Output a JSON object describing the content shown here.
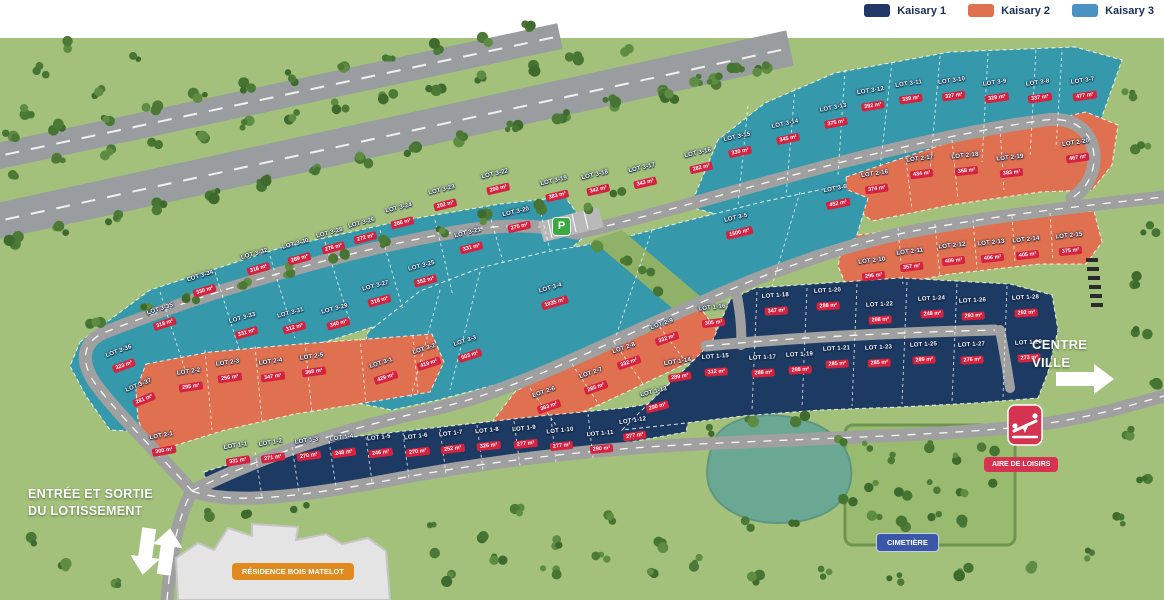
{
  "legend": {
    "items": [
      {
        "label": "Kaisary 1",
        "color": "#203767"
      },
      {
        "label": "Kaisary 2",
        "color": "#e0714f"
      },
      {
        "label": "Kaisary 3",
        "color": "#4a92c3"
      }
    ]
  },
  "labels": {
    "entrance_line1": "ENTRÉE ET SORTIE",
    "entrance_line2": "DU LOTISSEMENT",
    "residence": "RÉSIDENCE BOIS MATELOT",
    "cemetery": "CIMETIÈRE",
    "leisure": "AIRE DE LOISIRS",
    "centre_line1": "CENTRE",
    "centre_line2": "VILLE",
    "parking": "P"
  },
  "colors": {
    "zone_kaisary1": "#1d3a63",
    "zone_kaisary2": "#df7150",
    "zone_kaisary3": "#3598ab",
    "area_badge": "#d6213f"
  },
  "lots": [
    {
      "id": "LOT 3-1",
      "area": "429 m²",
      "g": 3,
      "x": 384,
      "y": 372,
      "r": -18
    },
    {
      "id": "LOT 3-2",
      "area": "419 m²",
      "g": 3,
      "x": 427,
      "y": 358,
      "r": -18
    },
    {
      "id": "LOT 3-3",
      "area": "503 m²",
      "g": 3,
      "x": 468,
      "y": 350,
      "r": -18
    },
    {
      "id": "LOT 3-4",
      "area": "1035 m²",
      "g": 3,
      "x": 553,
      "y": 297,
      "r": -16
    },
    {
      "id": "LOT 3-5",
      "area": "1506 m²",
      "g": 3,
      "x": 738,
      "y": 227,
      "r": -13
    },
    {
      "id": "LOT 3-6",
      "area": "452 m²",
      "g": 3,
      "x": 837,
      "y": 198,
      "r": -11
    },
    {
      "id": "LOT 3-7",
      "area": "477 m²",
      "g": 3,
      "x": 1084,
      "y": 90,
      "r": -8
    },
    {
      "id": "LOT 3-8",
      "area": "337 m²",
      "g": 3,
      "x": 1039,
      "y": 92,
      "r": -8
    },
    {
      "id": "LOT 3-9",
      "area": "329 m²",
      "g": 3,
      "x": 996,
      "y": 92,
      "r": -8
    },
    {
      "id": "LOT 3-10",
      "area": "327 m²",
      "g": 3,
      "x": 953,
      "y": 90,
      "r": -8
    },
    {
      "id": "LOT 3-11",
      "area": "339 m²",
      "g": 3,
      "x": 910,
      "y": 93,
      "r": -8
    },
    {
      "id": "LOT 3-12",
      "area": "392 m²",
      "g": 3,
      "x": 872,
      "y": 100,
      "r": -9
    },
    {
      "id": "LOT 3-13",
      "area": "375 m²",
      "g": 3,
      "x": 835,
      "y": 117,
      "r": -11
    },
    {
      "id": "LOT 3-14",
      "area": "345 m²",
      "g": 3,
      "x": 787,
      "y": 133,
      "r": -12
    },
    {
      "id": "LOT 3-15",
      "area": "330 m²",
      "g": 3,
      "x": 739,
      "y": 146,
      "r": -12
    },
    {
      "id": "LOT 3-16",
      "area": "282 m²",
      "g": 3,
      "x": 700,
      "y": 162,
      "r": -13
    },
    {
      "id": "LOT 3-17",
      "area": "343 m²",
      "g": 3,
      "x": 644,
      "y": 177,
      "r": -13
    },
    {
      "id": "LOT 3-18",
      "area": "342 m²",
      "g": 3,
      "x": 597,
      "y": 184,
      "r": -13
    },
    {
      "id": "LOT 3-19",
      "area": "383 m²",
      "g": 3,
      "x": 556,
      "y": 190,
      "r": -13
    },
    {
      "id": "LOT 3-20",
      "area": "275 m²",
      "g": 3,
      "x": 518,
      "y": 221,
      "r": -13
    },
    {
      "id": "LOT 3-21",
      "area": "331 m²",
      "g": 3,
      "x": 470,
      "y": 242,
      "r": -14
    },
    {
      "id": "LOT 3-22",
      "area": "290 m²",
      "g": 3,
      "x": 497,
      "y": 183,
      "r": -13
    },
    {
      "id": "LOT 3-23",
      "area": "292 m²",
      "g": 3,
      "x": 444,
      "y": 199,
      "r": -14
    },
    {
      "id": "LOT 3-24",
      "area": "286 m²",
      "g": 3,
      "x": 401,
      "y": 217,
      "r": -14
    },
    {
      "id": "LOT 3-25",
      "area": "352 m²",
      "g": 3,
      "x": 424,
      "y": 275,
      "r": -15
    },
    {
      "id": "LOT 3-26",
      "area": "272 m²",
      "g": 3,
      "x": 364,
      "y": 232,
      "r": -15
    },
    {
      "id": "LOT 3-27",
      "area": "318 m²",
      "g": 3,
      "x": 378,
      "y": 295,
      "r": -15
    },
    {
      "id": "LOT 3-28",
      "area": "276 m²",
      "g": 3,
      "x": 332,
      "y": 242,
      "r": -15
    },
    {
      "id": "LOT 3-29",
      "area": "340 m²",
      "g": 3,
      "x": 337,
      "y": 318,
      "r": -15
    },
    {
      "id": "LOT 3-30",
      "area": "289 m²",
      "g": 3,
      "x": 298,
      "y": 253,
      "r": -15
    },
    {
      "id": "LOT 3-31",
      "area": "312 m²",
      "g": 3,
      "x": 293,
      "y": 322,
      "r": -15
    },
    {
      "id": "LOT 3-32",
      "area": "316 m²",
      "g": 3,
      "x": 257,
      "y": 263,
      "r": -16
    },
    {
      "id": "LOT 3-33",
      "area": "331 m²",
      "g": 3,
      "x": 245,
      "y": 327,
      "r": -16
    },
    {
      "id": "LOT 3-34",
      "area": "330 m²",
      "g": 3,
      "x": 203,
      "y": 285,
      "r": -17
    },
    {
      "id": "LOT 3-35",
      "area": "318 m²",
      "g": 3,
      "x": 163,
      "y": 318,
      "r": -18
    },
    {
      "id": "LOT 3-36",
      "area": "323 m²",
      "g": 3,
      "x": 122,
      "y": 360,
      "r": -20
    },
    {
      "id": "LOT 3-37",
      "area": "281 m²",
      "g": 3,
      "x": 142,
      "y": 394,
      "r": -22
    },
    {
      "id": "LOT 2-1",
      "area": "300 m²",
      "g": 2,
      "x": 163,
      "y": 445,
      "r": -10
    },
    {
      "id": "LOT 2-2",
      "area": "295 m²",
      "g": 2,
      "x": 190,
      "y": 381,
      "r": -8
    },
    {
      "id": "LOT 2-3",
      "area": "256 m²",
      "g": 2,
      "x": 229,
      "y": 372,
      "r": -8
    },
    {
      "id": "LOT 2-4",
      "area": "347 m²",
      "g": 2,
      "x": 272,
      "y": 371,
      "r": -8
    },
    {
      "id": "LOT 2-5",
      "area": "368 m²",
      "g": 2,
      "x": 313,
      "y": 366,
      "r": -8
    },
    {
      "id": "LOT 2-6",
      "area": "363 m²",
      "g": 2,
      "x": 547,
      "y": 401,
      "r": -19
    },
    {
      "id": "LOT 2-7",
      "area": "285 m²",
      "g": 2,
      "x": 594,
      "y": 382,
      "r": -19
    },
    {
      "id": "LOT 2-8",
      "area": "332 m²",
      "g": 2,
      "x": 627,
      "y": 357,
      "r": -19
    },
    {
      "id": "LOT 2-9",
      "area": "332 m²",
      "g": 2,
      "x": 665,
      "y": 333,
      "r": -19
    },
    {
      "id": "LOT 2-10",
      "area": "296 m²",
      "g": 2,
      "x": 873,
      "y": 270,
      "r": -7
    },
    {
      "id": "LOT 2-11",
      "area": "357 m²",
      "g": 2,
      "x": 911,
      "y": 261,
      "r": -7
    },
    {
      "id": "LOT 2-12",
      "area": "409 m²",
      "g": 2,
      "x": 953,
      "y": 255,
      "r": -6
    },
    {
      "id": "LOT 2-13",
      "area": "406 m²",
      "g": 2,
      "x": 992,
      "y": 252,
      "r": -6
    },
    {
      "id": "LOT 2-14",
      "area": "405 m²",
      "g": 2,
      "x": 1027,
      "y": 249,
      "r": -6
    },
    {
      "id": "LOT 2-15",
      "area": "375 m²",
      "g": 2,
      "x": 1070,
      "y": 245,
      "r": -6
    },
    {
      "id": "LOT 2-16",
      "area": "374 m²",
      "g": 2,
      "x": 876,
      "y": 183,
      "r": -8
    },
    {
      "id": "LOT 2-17",
      "area": "434 m²",
      "g": 2,
      "x": 921,
      "y": 168,
      "r": -7
    },
    {
      "id": "LOT 2-18",
      "area": "368 m²",
      "g": 2,
      "x": 966,
      "y": 165,
      "r": -6
    },
    {
      "id": "LOT 2-19",
      "area": "383 m²",
      "g": 2,
      "x": 1011,
      "y": 167,
      "r": -6
    },
    {
      "id": "LOT 2-20",
      "area": "467 m²",
      "g": 2,
      "x": 1077,
      "y": 152,
      "r": -8
    },
    {
      "id": "LOT 1-1",
      "area": "331 m²",
      "g": 1,
      "x": 237,
      "y": 455,
      "r": -9
    },
    {
      "id": "LOT 1-2",
      "area": "271 m²",
      "g": 1,
      "x": 272,
      "y": 452,
      "r": -9
    },
    {
      "id": "LOT 1-3",
      "area": "270 m²",
      "g": 1,
      "x": 308,
      "y": 450,
      "r": -8
    },
    {
      "id": "LOT 1-4",
      "area": "248 m²",
      "g": 1,
      "x": 343,
      "y": 447,
      "r": -8
    },
    {
      "id": "LOT 1-5",
      "area": "246 m²",
      "g": 1,
      "x": 380,
      "y": 447,
      "r": -7
    },
    {
      "id": "LOT 1-6",
      "area": "270 m²",
      "g": 1,
      "x": 417,
      "y": 446,
      "r": -7
    },
    {
      "id": "LOT 1-7",
      "area": "252 m²",
      "g": 1,
      "x": 452,
      "y": 443,
      "r": -7
    },
    {
      "id": "LOT 1-8",
      "area": "326 m²",
      "g": 1,
      "x": 488,
      "y": 440,
      "r": -6
    },
    {
      "id": "LOT 1-9",
      "area": "277 m²",
      "g": 1,
      "x": 525,
      "y": 438,
      "r": -6
    },
    {
      "id": "LOT 1-10",
      "area": "277 m²",
      "g": 1,
      "x": 561,
      "y": 440,
      "r": -6
    },
    {
      "id": "LOT 1-11",
      "area": "290 m²",
      "g": 1,
      "x": 601,
      "y": 443,
      "r": -5
    },
    {
      "id": "LOT 1-12",
      "area": "277 m²",
      "g": 1,
      "x": 634,
      "y": 430,
      "r": -8
    },
    {
      "id": "LOT 1-13",
      "area": "290 m²",
      "g": 1,
      "x": 656,
      "y": 401,
      "r": -14
    },
    {
      "id": "LOT 1-14",
      "area": "289 m²",
      "g": 1,
      "x": 679,
      "y": 371,
      "r": -9
    },
    {
      "id": "LOT 1-15",
      "area": "312 m²",
      "g": 1,
      "x": 716,
      "y": 366,
      "r": -4
    },
    {
      "id": "LOT 1-16",
      "area": "305 m²",
      "g": 1,
      "x": 713,
      "y": 317,
      "r": -6
    },
    {
      "id": "LOT 1-17",
      "area": "288 m²",
      "g": 1,
      "x": 763,
      "y": 367,
      "r": -3
    },
    {
      "id": "LOT 1-18",
      "area": "347 m²",
      "g": 1,
      "x": 776,
      "y": 305,
      "r": -4
    },
    {
      "id": "LOT 1-19",
      "area": "288 m²",
      "g": 1,
      "x": 800,
      "y": 364,
      "r": -3
    },
    {
      "id": "LOT 1-20",
      "area": "288 m²",
      "g": 1,
      "x": 828,
      "y": 300,
      "r": -3
    },
    {
      "id": "LOT 1-21",
      "area": "285 m²",
      "g": 1,
      "x": 837,
      "y": 358,
      "r": -3
    },
    {
      "id": "LOT 1-22",
      "area": "288 m²",
      "g": 1,
      "x": 880,
      "y": 314,
      "r": -3
    },
    {
      "id": "LOT 1-23",
      "area": "285 m²",
      "g": 1,
      "x": 879,
      "y": 357,
      "r": -3
    },
    {
      "id": "LOT 1-24",
      "area": "248 m²",
      "g": 1,
      "x": 932,
      "y": 308,
      "r": -3
    },
    {
      "id": "LOT 1-25",
      "area": "289 m²",
      "g": 1,
      "x": 924,
      "y": 354,
      "r": -3
    },
    {
      "id": "LOT 1-26",
      "area": "293 m²",
      "g": 1,
      "x": 973,
      "y": 310,
      "r": -3
    },
    {
      "id": "LOT 1-27",
      "area": "276 m²",
      "g": 1,
      "x": 972,
      "y": 354,
      "r": -3
    },
    {
      "id": "LOT 1-28",
      "area": "292 m²",
      "g": 1,
      "x": 1026,
      "y": 307,
      "r": -3
    },
    {
      "id": "LOT 1-29",
      "area": "273 m²",
      "g": 1,
      "x": 1029,
      "y": 352,
      "r": -3
    }
  ]
}
